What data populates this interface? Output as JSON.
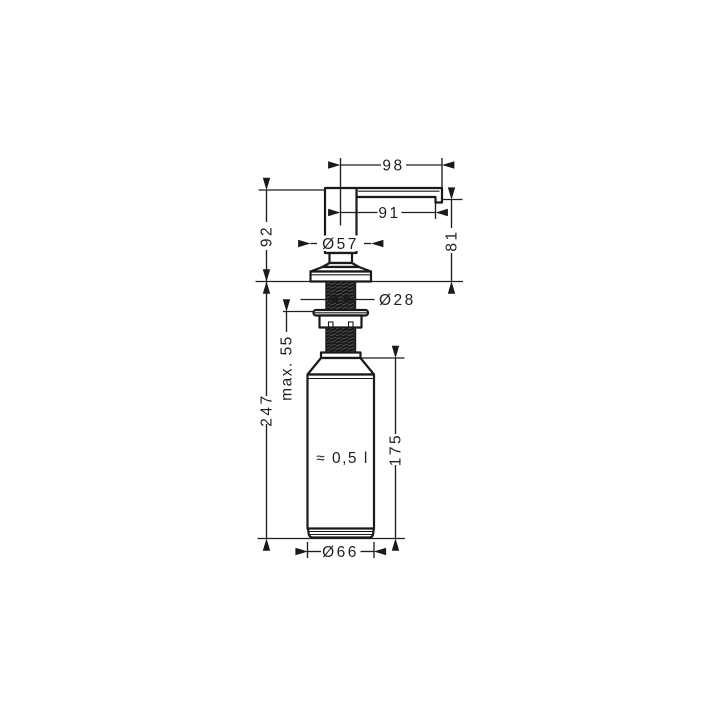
{
  "page": {
    "background": "#ffffff",
    "line_color": "#1a1a1a"
  },
  "drawing": {
    "type": "technical-dimension-drawing",
    "labels": {
      "d98": "98",
      "d91": "91",
      "d57": "Ø57",
      "d92": "92",
      "d81": "81",
      "d28": "Ø28",
      "d55": "max. 55",
      "d247": "247",
      "d175": "175",
      "d66": "Ø66",
      "capacity": "≈ 0,5 l"
    }
  }
}
